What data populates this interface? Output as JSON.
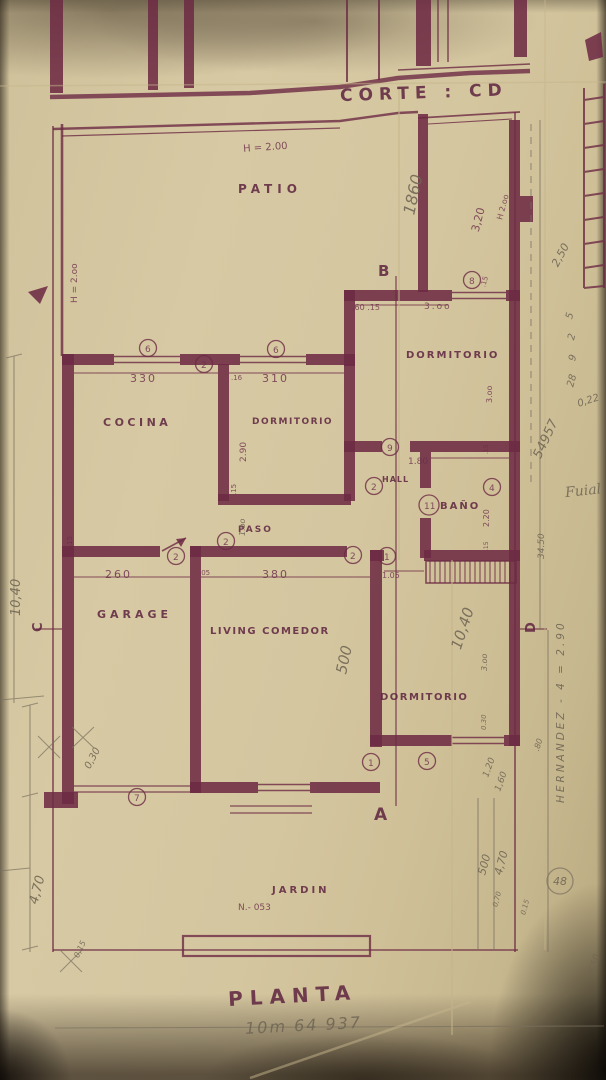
{
  "corte": {
    "title": "CORTE : CD"
  },
  "plan": {
    "title": "PLANTA",
    "note": "10m  64 937"
  },
  "rooms": {
    "patio": "PATIO",
    "cocina": "COCINA",
    "dormitorio_1": "DORMITORIO",
    "dormitorio_2": "DORMITORIO",
    "dormitorio_3": "DORMITORIO",
    "hall": "HALL",
    "bano": "BAÑO",
    "paso": "PASO",
    "garage": "GARAGE",
    "living": "LIVING COMEDOR",
    "jardin": "JARDIN"
  },
  "markers": {
    "a": "A",
    "b": "B",
    "c": "C",
    "d": "D"
  },
  "dims": {
    "h200_patio": "H = 2.00",
    "h200_left": "H = 2.oo",
    "h200_side": "H 2.oo",
    "d1860": "1860",
    "d320": "3,20",
    "d250_side": "2,50",
    "d60": ".60 .15",
    "d300_top": "3.oo",
    "d15_corner": ".15",
    "d300_right_v": "3.oo",
    "d330": "330",
    "d16": ".16",
    "d310": "310",
    "d290": "2.90",
    "d15_left": ".15",
    "d15_div": ".15",
    "d180": "1.80",
    "d220": "2.20",
    "d15_bano_a": ".15",
    "d15_bano_b": ".15",
    "d100_paso": "1.oo",
    "d105": "1.05",
    "d260": "260",
    "d05": ".05",
    "d380": "380",
    "d500_living": "500",
    "d1040_dorm": "10,40",
    "d300_dorm3": "3.oo",
    "d030_dorm3": "0.30",
    "n053": "N.- 053"
  },
  "margins": {
    "left_1040": "10,40",
    "left_470": "4,70",
    "left_030": "0,30",
    "left_015": "0,15",
    "right_54957": "54957",
    "right_3450": "34.50",
    "right_hernandez": "HERNANDEZ - 4 = 2.90",
    "right_022": "0,22",
    "right_fuial": "Fuial",
    "right_5": "5",
    "right_2": "2",
    "right_9": "9",
    "right_28": "28",
    "right_80": ".80",
    "right_120": "1.20",
    "right_160": "1,60",
    "right_500": "500",
    "right_470": "4,70",
    "right_070": "0,70",
    "right_015": "0.15",
    "right_250_bottom": "2.50",
    "right_48": "48"
  },
  "circles": {
    "c1": "6",
    "c2": "2",
    "c3": "6",
    "c4": "8",
    "c5": "9",
    "c6": "2",
    "c7": "11",
    "c8": "4",
    "c9": "1",
    "c10": "2",
    "c11": "2",
    "c12": "2",
    "c13": "1",
    "c14": "5",
    "c15": "7"
  }
}
